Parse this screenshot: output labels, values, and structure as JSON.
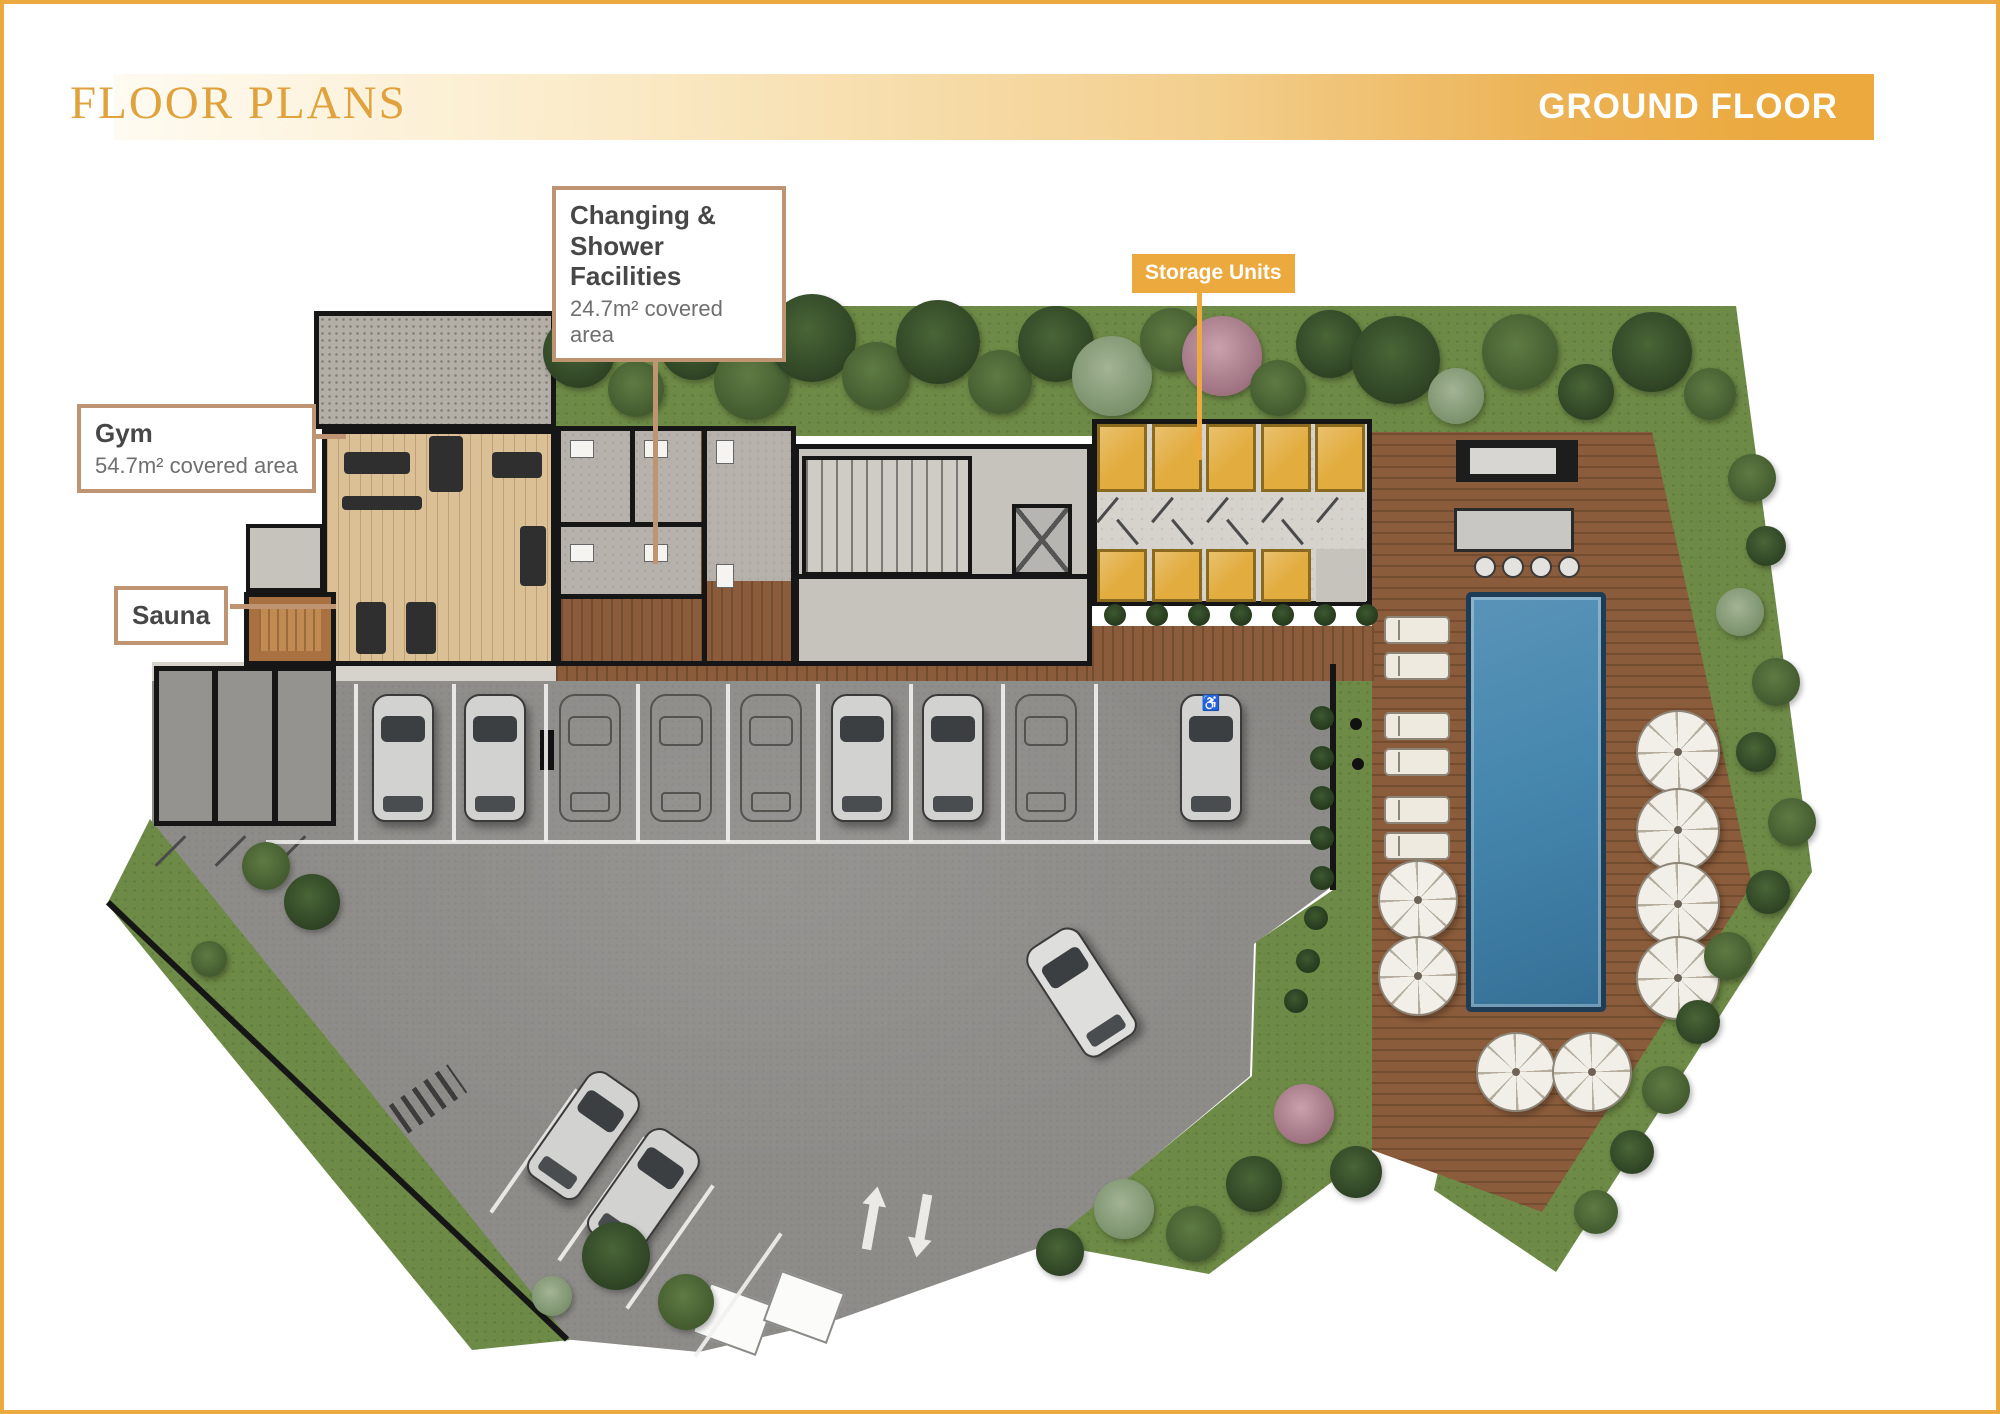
{
  "header": {
    "title": "FLOOR PLANS",
    "floor_label": "GROUND FLOOR"
  },
  "callouts": {
    "changing": {
      "title": "Changing & Shower Facilities",
      "area": "24.7m² covered area"
    },
    "gym": {
      "title": "Gym",
      "area": "54.7m² covered area"
    },
    "sauna": {
      "title": "Sauna"
    },
    "storage": {
      "title": "Storage Units"
    }
  },
  "icons": {
    "accessible": "♿"
  },
  "colors": {
    "accent": "#EBA93E",
    "gold": "#DFA23C",
    "callout_border": "#BE9472",
    "text_dark": "#474747",
    "text_gray": "#6F6F6F",
    "wall": "#161616",
    "grass": "#6D8A46",
    "asphalt": "#8E8C89",
    "deck": "#8A5C3B",
    "wood_light": "#DCC095",
    "wood_mid": "#9C6B44",
    "pool": "#4687AE",
    "pool_edge": "#1E3D55",
    "storage": "#E2AC3E",
    "tile": "#B6B2AB",
    "concrete": "#C6C3BD",
    "white_line": "#F2F1EE"
  }
}
